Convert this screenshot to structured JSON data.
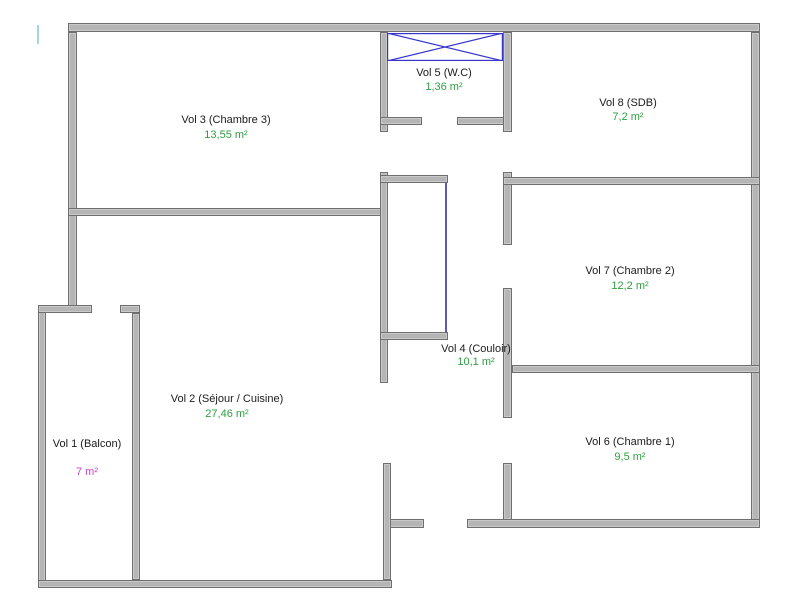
{
  "page": {
    "width": 811,
    "height": 608,
    "background": "#ffffff"
  },
  "floorplan": {
    "wall_fill_color": "#b5b5b5",
    "wall_border_color": "#6f6f6f",
    "room_name_color": "#1b1b1b",
    "area_default_color": "#2f9e42",
    "rooms": [
      {
        "label": "Vol 1 (Balcon)",
        "area": "7 m²",
        "area_color": "#cc44cc",
        "cx": 87,
        "name_y": 438,
        "area_y": 466
      },
      {
        "label": "Vol 2 (Séjour / Cuisine)",
        "area": "27,46 m²",
        "area_color": "#2f9e42",
        "cx": 227,
        "name_y": 393,
        "area_y": 408
      },
      {
        "label": "Vol 3 (Chambre 3)",
        "area": "13,55 m²",
        "area_color": "#2f9e42",
        "cx": 226,
        "name_y": 114,
        "area_y": 129
      },
      {
        "label": "Vol 4 (Couloir)",
        "area": "10,1 m²",
        "area_color": "#2f9e42",
        "cx": 476,
        "name_y": 343,
        "area_y": 356
      },
      {
        "label": "Vol 5 (W.C)",
        "area": "1,36 m²",
        "area_color": "#2f9e42",
        "cx": 444,
        "name_y": 67,
        "area_y": 81
      },
      {
        "label": "Vol 6 (Chambre 1)",
        "area": "9,5 m²",
        "area_color": "#2f9e42",
        "cx": 630,
        "name_y": 436,
        "area_y": 451
      },
      {
        "label": "Vol 7 (Chambre 2)",
        "area": "12,2 m²",
        "area_color": "#2f9e42",
        "cx": 630,
        "name_y": 265,
        "area_y": 280
      },
      {
        "label": "Vol 8 (SDB)",
        "area": "7,2 m²",
        "area_color": "#2f9e42",
        "cx": 628,
        "name_y": 97,
        "area_y": 111
      }
    ],
    "walls": [
      {
        "name": "outer-top",
        "rect": [
          68,
          23,
          692,
          9
        ]
      },
      {
        "name": "outer-left-upper",
        "rect": [
          68,
          32,
          9,
          281
        ]
      },
      {
        "name": "outer-right",
        "rect": [
          751,
          32,
          9,
          496
        ]
      },
      {
        "name": "bottom-right-seg-a",
        "rect": [
          383,
          519,
          41,
          9
        ]
      },
      {
        "name": "bottom-right-seg-b",
        "rect": [
          467,
          519,
          293,
          9
        ]
      },
      {
        "name": "balcony-left",
        "rect": [
          38,
          305,
          8,
          283
        ]
      },
      {
        "name": "main-bottom",
        "rect": [
          38,
          580,
          354,
          8
        ]
      },
      {
        "name": "vol2-right-lower",
        "rect": [
          383,
          463,
          8,
          117
        ]
      },
      {
        "name": "balcony-top-seg-a",
        "rect": [
          38,
          305,
          54,
          8
        ]
      },
      {
        "name": "balcony-top-seg-b",
        "rect": [
          120,
          305,
          20,
          8
        ]
      },
      {
        "name": "balcony-right",
        "rect": [
          132,
          313,
          8,
          267
        ]
      },
      {
        "name": "vol3-bottom",
        "rect": [
          68,
          208,
          319,
          8
        ]
      },
      {
        "name": "mid-left-seg-a",
        "rect": [
          380,
          32,
          8,
          100
        ]
      },
      {
        "name": "mid-left-seg-b",
        "rect": [
          380,
          172,
          8,
          211
        ]
      },
      {
        "name": "closet-top",
        "rect": [
          380,
          175,
          68,
          8
        ]
      },
      {
        "name": "closet-bottom",
        "rect": [
          380,
          332,
          68,
          8
        ]
      },
      {
        "name": "wc-bottom-seg-a",
        "rect": [
          380,
          117,
          42,
          8
        ]
      },
      {
        "name": "wc-bottom-seg-b",
        "rect": [
          457,
          117,
          55,
          8
        ]
      },
      {
        "name": "mid-right-seg-a",
        "rect": [
          503,
          32,
          9,
          100
        ]
      },
      {
        "name": "mid-right-seg-b",
        "rect": [
          503,
          172,
          9,
          73
        ]
      },
      {
        "name": "mid-right-seg-c",
        "rect": [
          503,
          288,
          9,
          130
        ]
      },
      {
        "name": "mid-right-seg-d",
        "rect": [
          503,
          463,
          9,
          57
        ]
      },
      {
        "name": "vol8-bottom",
        "rect": [
          503,
          177,
          257,
          8
        ]
      },
      {
        "name": "vol6-vol7-divider",
        "rect": [
          512,
          365,
          248,
          8
        ]
      }
    ],
    "features": [
      {
        "name": "wc-window-x-marker",
        "type": "x-box",
        "rect": [
          387,
          33,
          116,
          28
        ],
        "color": "#3535cd"
      },
      {
        "name": "closet-front-line",
        "type": "line",
        "rect": [
          445,
          183,
          2,
          149
        ],
        "color": "#5b5bb5"
      },
      {
        "name": "left-edge-tick",
        "type": "line",
        "rect": [
          37,
          25,
          2,
          19
        ],
        "color": "#a5d5e5"
      }
    ]
  }
}
